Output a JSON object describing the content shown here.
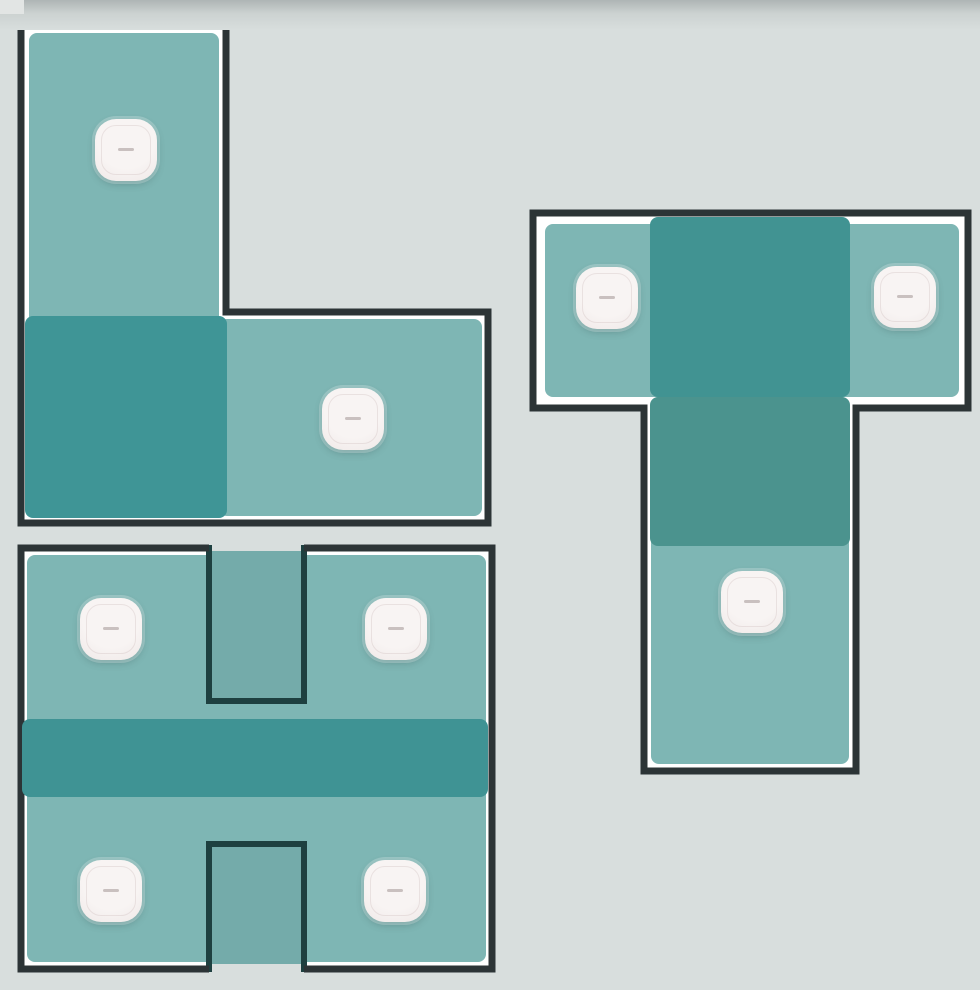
{
  "colors": {
    "bg": "#d8dedd",
    "bg_top": "#aeb5b5",
    "bg_top_mid": "#ccd2d1",
    "corner_patch": "#e2e5e4",
    "wall": "#2c3436",
    "wall_notch": "#1e4040",
    "white": "#ffffff",
    "floor": "#7eb6b4",
    "floor_notch": "#74abaa",
    "overlay_l": "#3f9596",
    "overlay_band": "#3f9394",
    "overlay_t_upper": "#419392",
    "overlay_t_lower": "#4b938e",
    "ap_body": "#f8f4f3",
    "ap_body_edge": "#efe8e7",
    "ap_dash": "#c9c0bf"
  },
  "floorplan": {
    "canvas": {
      "width": 980,
      "height": 990
    },
    "ap_size": 62,
    "buildings": [
      {
        "name": "building-l-shape",
        "shapes": [
          {
            "kind": "path",
            "name": "building-underlay",
            "d": "M21 25 H226 V312 H488 V523 H21 Z",
            "fill": "white"
          },
          {
            "kind": "rect",
            "name": "floor-fill",
            "x": 29,
            "y": 33,
            "w": 190,
            "h": 483,
            "r": 8,
            "fill": "floor"
          },
          {
            "kind": "rect",
            "name": "floor-fill",
            "x": 219,
            "y": 319,
            "w": 263,
            "h": 197,
            "r": 8,
            "fill": "floor"
          },
          {
            "kind": "rect",
            "name": "coverage-overlay",
            "x": 25,
            "y": 316,
            "w": 202,
            "h": 202,
            "r": 8,
            "fill": "overlay_l"
          },
          {
            "kind": "path",
            "name": "wall-outline",
            "d": "M21 25 H226 V312 H488 V523 H21 Z",
            "stroke": "wall",
            "sw": 7
          }
        ]
      },
      {
        "name": "building-t-shape",
        "shapes": [
          {
            "kind": "path",
            "name": "building-underlay",
            "d": "M533 213 H968 V408 H856 V771 H644 V408 H533 Z",
            "fill": "white"
          },
          {
            "kind": "rect",
            "name": "floor-fill",
            "x": 545,
            "y": 224,
            "w": 414,
            "h": 173,
            "r": 8,
            "fill": "floor"
          },
          {
            "kind": "rect",
            "name": "floor-fill",
            "x": 651,
            "y": 397,
            "w": 198,
            "h": 367,
            "r": 8,
            "fill": "floor"
          },
          {
            "kind": "rect",
            "name": "coverage-overlay",
            "x": 650,
            "y": 217,
            "w": 200,
            "h": 180,
            "r": 8,
            "fill": "overlay_t_upper"
          },
          {
            "kind": "rect",
            "name": "coverage-overlay",
            "x": 650,
            "y": 397,
            "w": 200,
            "h": 149,
            "r": 8,
            "fill": "overlay_t_lower"
          },
          {
            "kind": "path",
            "name": "wall-outline",
            "d": "M533 213 H968 V408 H856 V771 H644 V408 H533 Z",
            "stroke": "wall",
            "sw": 7
          }
        ]
      },
      {
        "name": "building-h-shape",
        "shapes": [
          {
            "kind": "rect",
            "name": "building-underlay",
            "x": 18,
            "y": 545,
            "w": 477,
            "h": 427,
            "fill": "white"
          },
          {
            "kind": "rect",
            "name": "floor-fill",
            "x": 27,
            "y": 555,
            "w": 459,
            "h": 407,
            "r": 8,
            "fill": "floor"
          },
          {
            "kind": "rect",
            "name": "courtyard-fill",
            "x": 210,
            "y": 551,
            "w": 93,
            "h": 150,
            "fill": "floor_notch"
          },
          {
            "kind": "rect",
            "name": "courtyard-fill",
            "x": 210,
            "y": 845,
            "w": 93,
            "h": 120,
            "fill": "floor_notch"
          },
          {
            "kind": "rect",
            "name": "background-mask",
            "x": 212,
            "y": 541,
            "w": 89,
            "h": 10,
            "fill": "bg"
          },
          {
            "kind": "rect",
            "name": "background-mask",
            "x": 212,
            "y": 964,
            "w": 89,
            "h": 11,
            "fill": "bg"
          },
          {
            "kind": "path",
            "name": "courtyard-wall",
            "d": "M209 545 V701 H304 V545",
            "stroke": "wall_notch",
            "sw": 6
          },
          {
            "kind": "path",
            "name": "courtyard-wall",
            "d": "M209 972 V844 H304 V972",
            "stroke": "wall_notch",
            "sw": 6
          },
          {
            "kind": "path",
            "name": "wall-outline",
            "d": "M209 548 H21 V969 H209 M304 548 H492 V969 H304",
            "stroke": "wall",
            "sw": 7
          },
          {
            "kind": "rect",
            "name": "coverage-overlay",
            "x": 22,
            "y": 719,
            "w": 466,
            "h": 78,
            "r": 8,
            "fill": "overlay_band"
          }
        ]
      }
    ],
    "access_points": [
      {
        "building": "building-l-shape",
        "x": 126,
        "y": 150
      },
      {
        "building": "building-l-shape",
        "x": 353,
        "y": 419
      },
      {
        "building": "building-t-shape",
        "x": 607,
        "y": 298
      },
      {
        "building": "building-t-shape",
        "x": 905,
        "y": 297
      },
      {
        "building": "building-t-shape",
        "x": 752,
        "y": 602
      },
      {
        "building": "building-h-shape",
        "x": 111,
        "y": 629
      },
      {
        "building": "building-h-shape",
        "x": 396,
        "y": 629
      },
      {
        "building": "building-h-shape",
        "x": 111,
        "y": 891
      },
      {
        "building": "building-h-shape",
        "x": 395,
        "y": 891
      }
    ]
  }
}
